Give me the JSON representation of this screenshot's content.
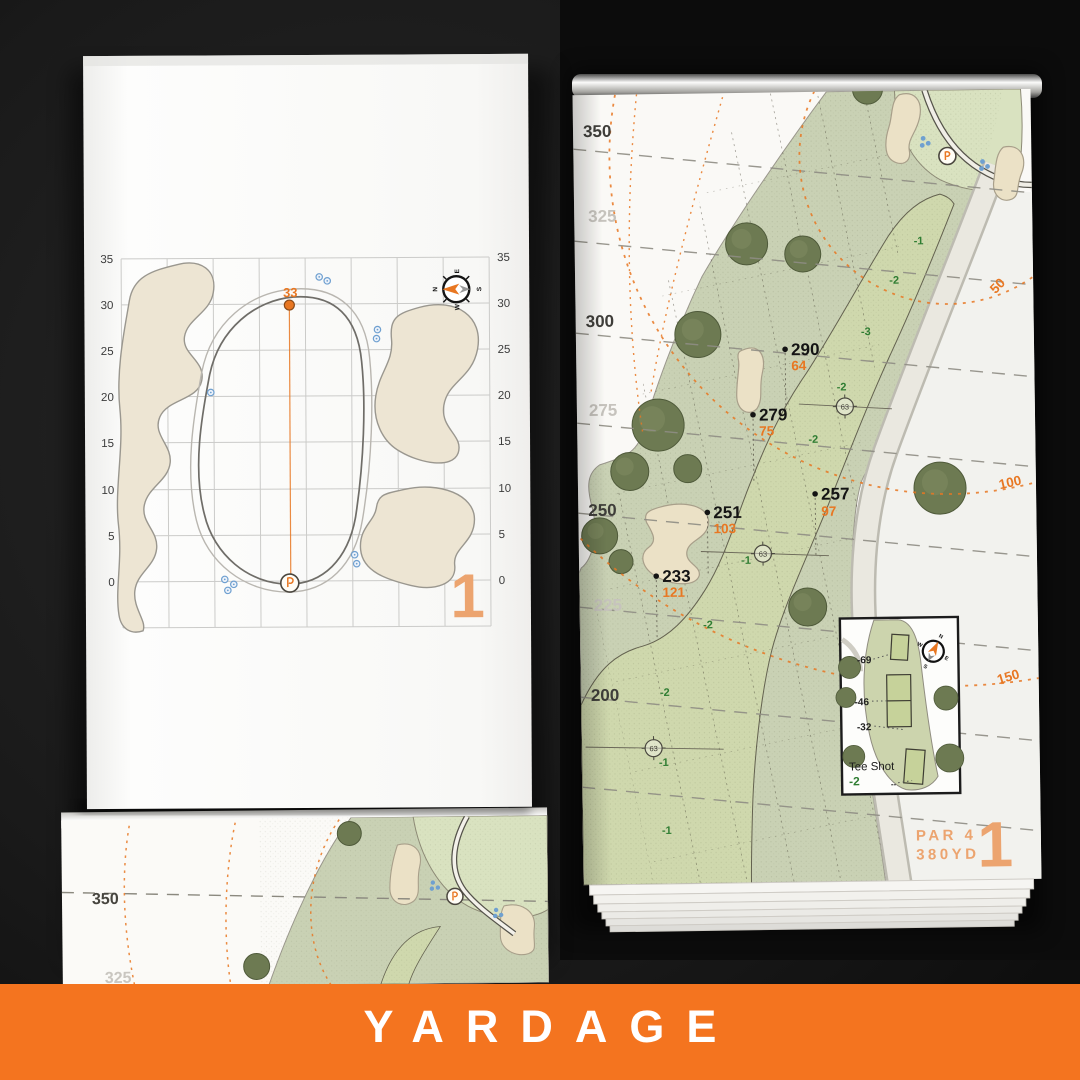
{
  "banner": {
    "title": "YARDAGE"
  },
  "compass": {
    "n": "N",
    "e": "E",
    "s": "S",
    "w": "W"
  },
  "colors": {
    "accent_orange": "#E87722",
    "soft_orange": "#ECA46F",
    "banner_orange": "#F4741F",
    "slope_green": "#2F7D32",
    "carry_black": "#141414",
    "fairway_green": "#CFD8AD",
    "rough_green": "#C9D1B4",
    "bunker_sand": "#EBE1C6",
    "tree_green": "#6D7A52",
    "sprinkler_blue": "#6FA0D0"
  },
  "green_page": {
    "pin_distance": "33",
    "hole_number": "1",
    "axis_ticks": [
      "35",
      "30",
      "25",
      "20",
      "15",
      "10",
      "5",
      "0"
    ]
  },
  "hole_page": {
    "hole_number": "1",
    "par": "PAR 4",
    "yardage": "380YD",
    "edge_yardages": [
      "350",
      "325",
      "300",
      "275",
      "250",
      "225",
      "200"
    ],
    "arc_distances": [
      "50",
      "100",
      "150"
    ],
    "carry_points": [
      {
        "carry": "290",
        "remain": "64"
      },
      {
        "carry": "279",
        "remain": "75"
      },
      {
        "carry": "257",
        "remain": "97"
      },
      {
        "carry": "251",
        "remain": "103"
      },
      {
        "carry": "233",
        "remain": "121"
      }
    ],
    "slopes": [
      "-1",
      "-2",
      "-3",
      "-2",
      "-2",
      "-1",
      "-2",
      "-2",
      "-1",
      "-1"
    ],
    "sprinkler_head": "63",
    "tee_inset": {
      "title": "Tee Shot",
      "slope": "-2",
      "offsets": [
        "-69",
        "-46",
        "-32"
      ],
      "tee_mark": "--"
    }
  },
  "next_page_peek": {
    "edge_yardages": [
      "350",
      "325"
    ]
  }
}
